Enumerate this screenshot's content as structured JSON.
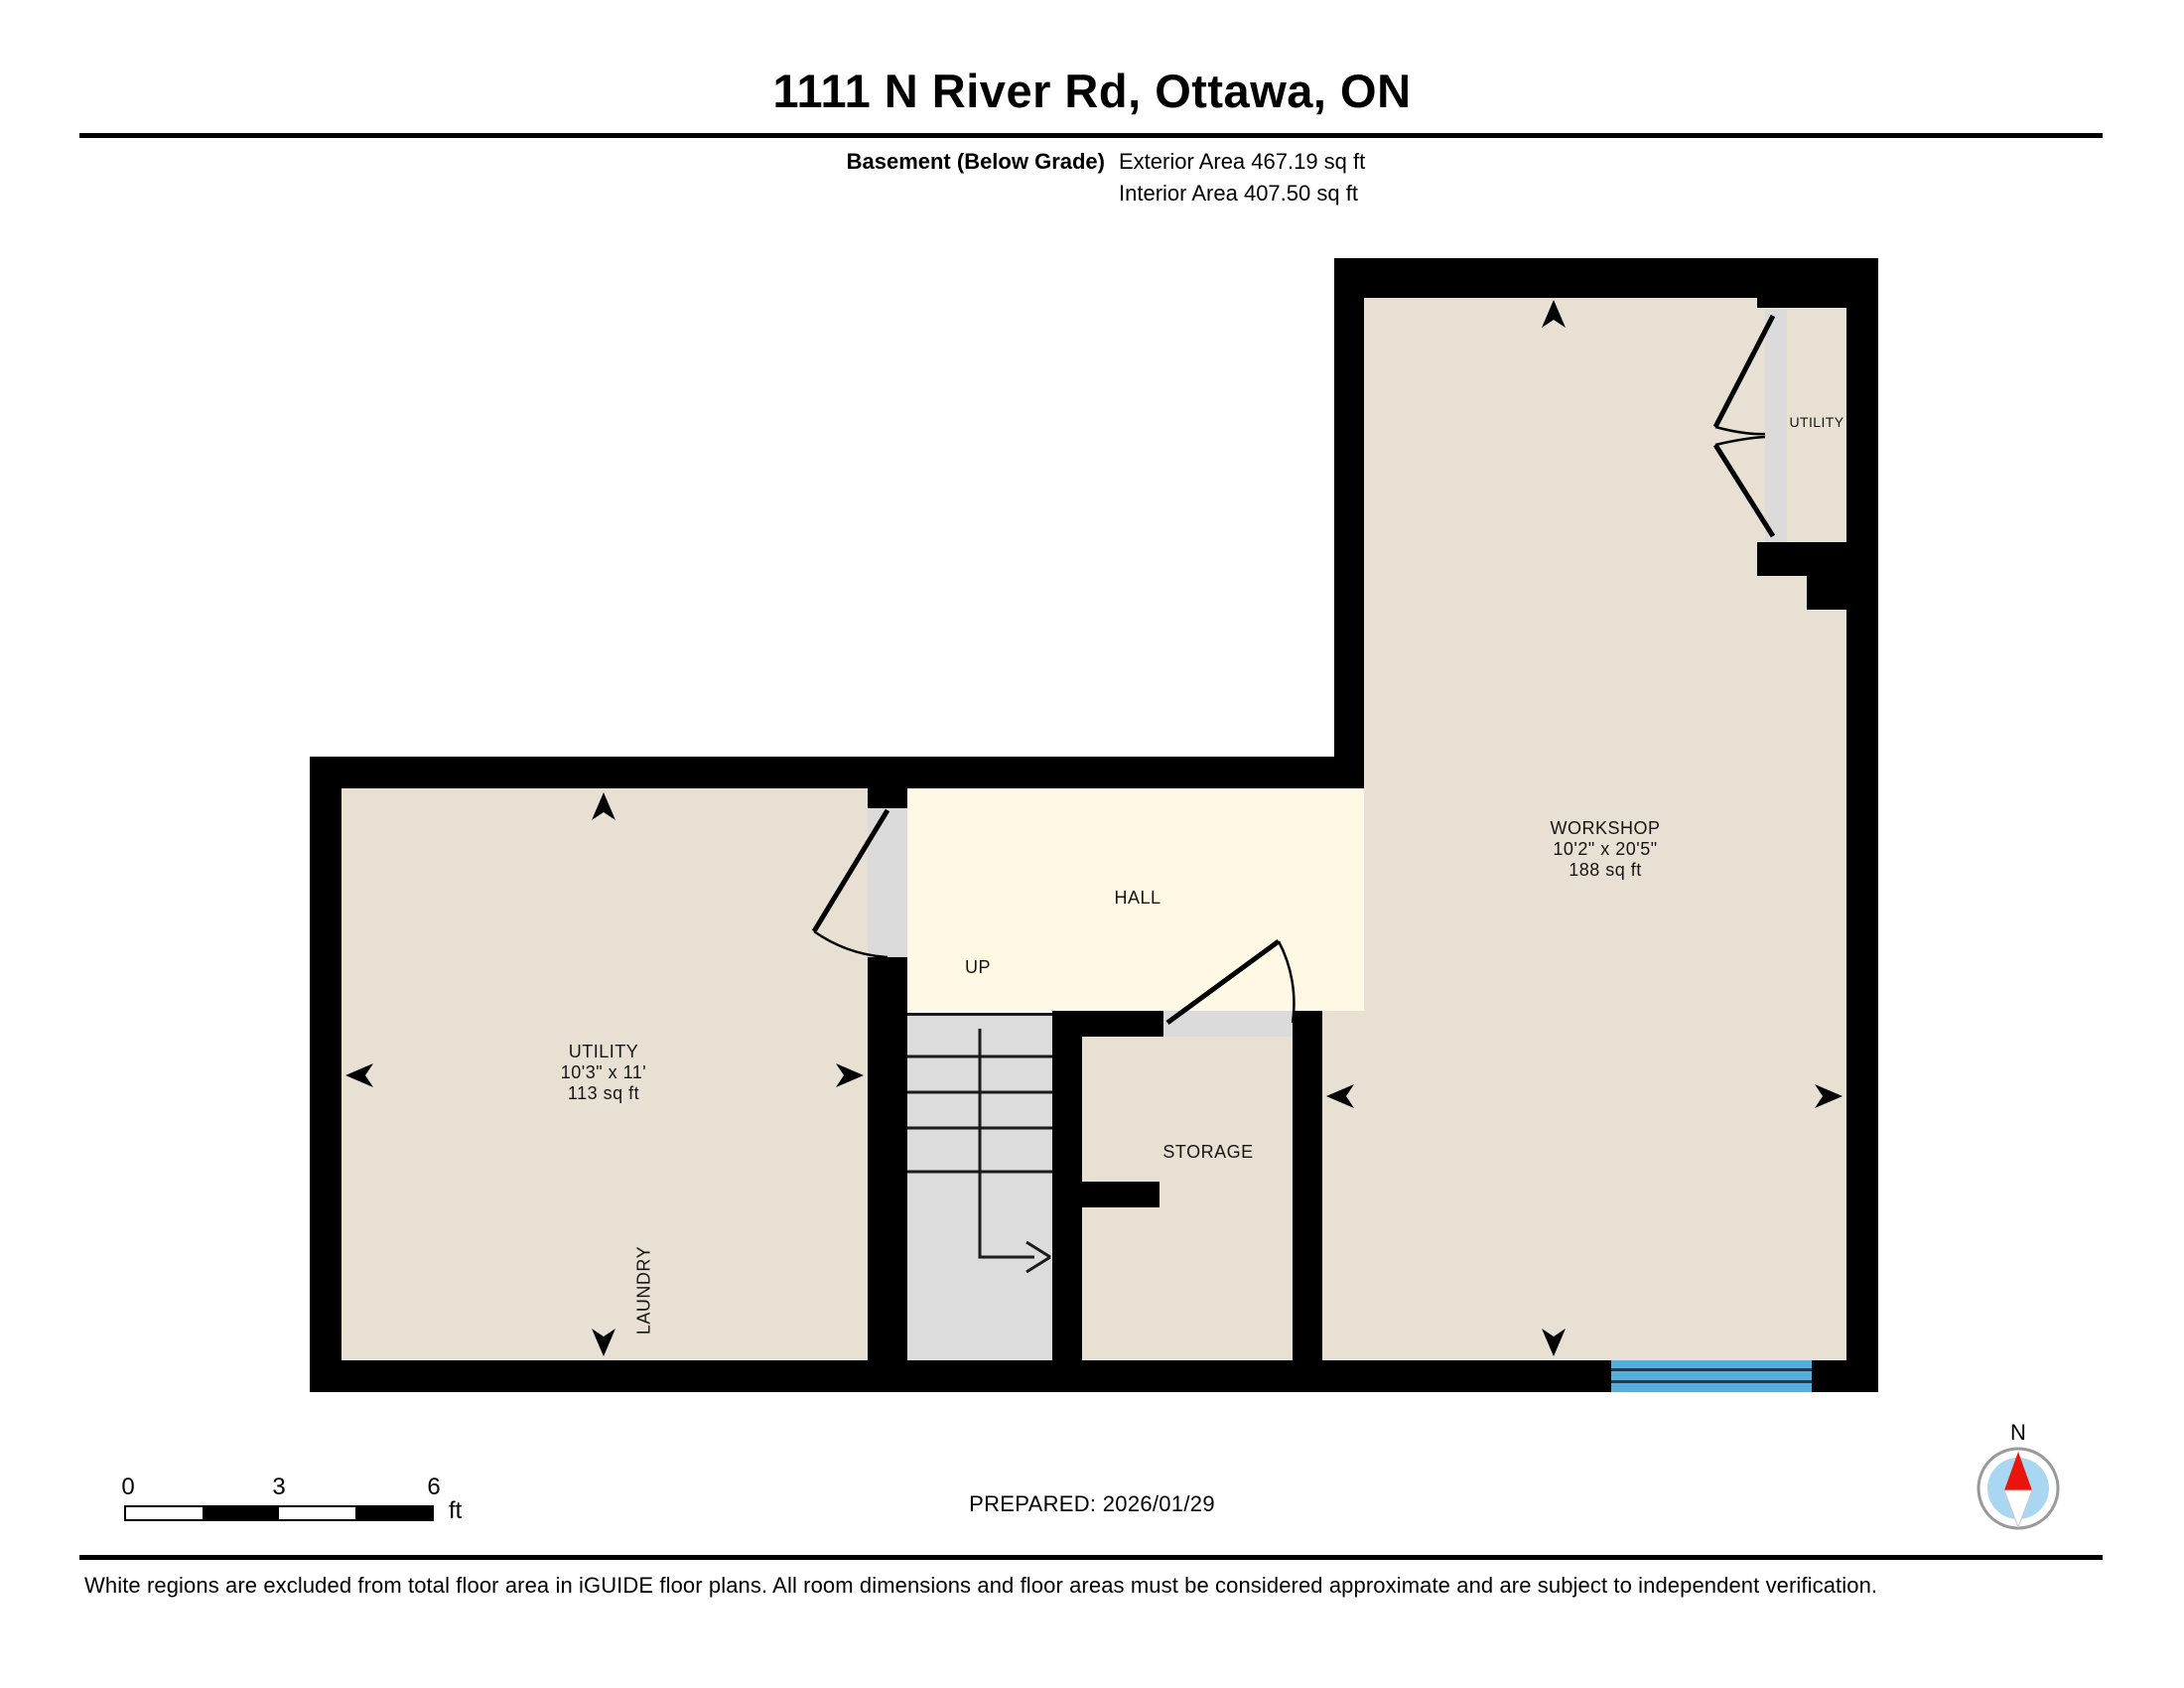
{
  "header": {
    "title": "1111 N River Rd, Ottawa, ON",
    "floor_label": "Basement (Below Grade)",
    "exterior_area": "Exterior Area 467.19 sq ft",
    "interior_area": "Interior Area 407.50 sq ft"
  },
  "rooms": {
    "utility": {
      "name": "UTILITY",
      "dimensions": "10'3\" x 11'",
      "area": "113 sq ft"
    },
    "laundry": {
      "name": "LAUNDRY"
    },
    "hall": {
      "name": "HALL"
    },
    "stairs": {
      "direction_label": "UP"
    },
    "storage": {
      "name": "STORAGE"
    },
    "workshop": {
      "name": "WORKSHOP",
      "dimensions": "10'2\" x 20'5\"",
      "area": "188 sq ft"
    },
    "utility_closet": {
      "name": "UTILITY"
    }
  },
  "scale_bar": {
    "ticks": [
      "0",
      "3",
      "6"
    ],
    "unit": "ft"
  },
  "compass": {
    "north_label": "N"
  },
  "footer": {
    "prepared": "PREPARED: 2026/01/29",
    "disclaimer": "White regions are excluded from total floor area in iGUIDE floor plans. All room dimensions and floor areas must be considered approximate and are subject to independent verification."
  },
  "colors": {
    "wall": "#000000",
    "roomFill": "#E8E1D3",
    "hallFill": "#FFF8E4",
    "stairFill": "#DCDCDC",
    "thresholdFill": "#DBDBDB",
    "windowBlue": "#54AEDC",
    "windowLine": "#1A3C54",
    "compassBlue": "#A9D7F2",
    "compassRed": "#E8150D",
    "compassRing": "#999999"
  }
}
